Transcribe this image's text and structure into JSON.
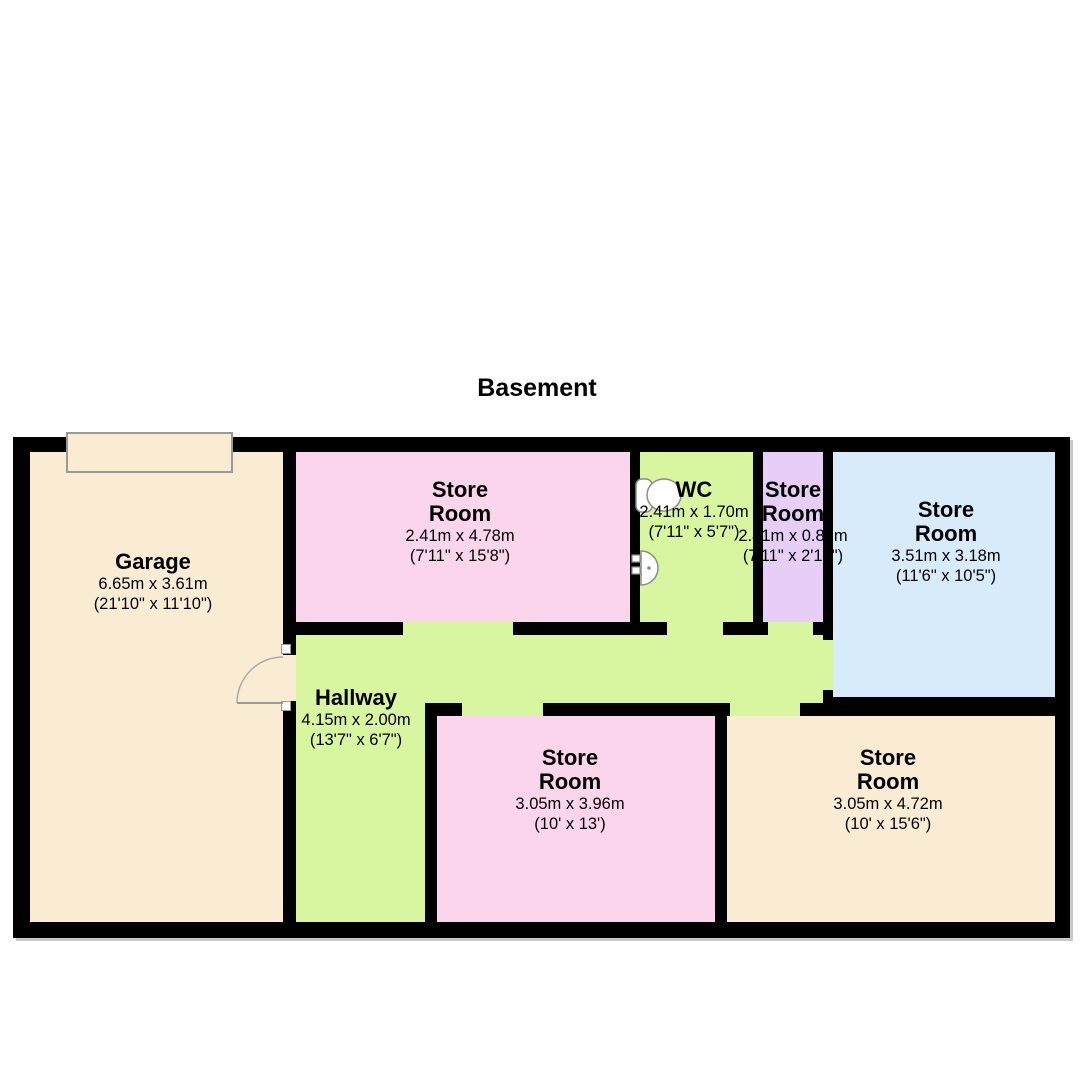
{
  "title": "Basement",
  "colors": {
    "wall": "#000000",
    "cream": "#FAEBD3",
    "pink": "#FBD5EC",
    "green": "#D8F6A0",
    "purple": "#E6CEF6",
    "blue": "#D7EBFA",
    "door_frame": "#999999",
    "fixture_stroke": "#8C8C8C",
    "shadow": "#C9C9C9"
  },
  "rooms": [
    {
      "name": "Garage",
      "metric": "6.65m x 3.61m",
      "imperial": "(21'10\" x 11'10\")"
    },
    {
      "name": "Store\nRoom",
      "metric": "2.41m x 4.78m",
      "imperial": "(7'11\" x 15'8\")"
    },
    {
      "name": "WC",
      "metric": "2.41m x 1.70m",
      "imperial": "(7'11\" x 5'7\")"
    },
    {
      "name": "Store\nRoom",
      "metric": "2.41m x 0.87m",
      "imperial": "(7'11\" x 2'10\")"
    },
    {
      "name": "Store\nRoom",
      "metric": "3.51m x 3.18m",
      "imperial": "(11'6\" x 10'5\")"
    },
    {
      "name": "Hallway",
      "metric": "4.15m x 2.00m",
      "imperial": "(13'7\" x 6'7\")"
    },
    {
      "name": "Store\nRoom",
      "metric": "3.05m x 3.96m",
      "imperial": "(10' x 13')"
    },
    {
      "name": "Store\nRoom",
      "metric": "3.05m x 4.72m",
      "imperial": "(10' x 15'6\")"
    }
  ]
}
